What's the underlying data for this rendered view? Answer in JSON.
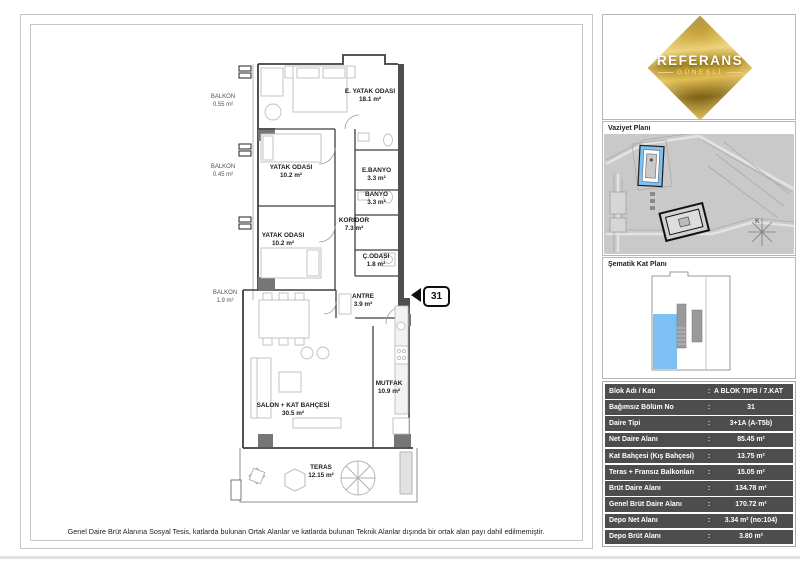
{
  "page": {
    "disclaimer": "Genel Daire Brüt Alanına Sosyal Tesis, katlarda bulunan Ortak Alanlar ve katlarda bulunan Teknik Alanlar dışında bir ortak alan payı dahil edilmemiştir."
  },
  "logo": {
    "title": "REFERANS",
    "subtitle": "GÜNEŞLİ"
  },
  "side": {
    "site_plan_label": "Vaziyet Planı",
    "schematic_label": "Şematik Kat Planı",
    "compass_label": "K"
  },
  "plan": {
    "unit_number": "31",
    "rooms": [
      {
        "name": "E. YATAK ODASI",
        "area": "18.1 m²"
      },
      {
        "name": "YATAK ODASI",
        "area": "10.2 m²"
      },
      {
        "name": "YATAK ODASI",
        "area": "10.2 m²"
      },
      {
        "name": "E.BANYO",
        "area": "3.3 m²"
      },
      {
        "name": "BANYO",
        "area": "3.3 m²"
      },
      {
        "name": "KORIDOR",
        "area": "7.3 m²"
      },
      {
        "name": "Ç.ODASI",
        "area": "1.8 m²"
      },
      {
        "name": "ANTRE",
        "area": "3.9 m²"
      },
      {
        "name": "MUTFAK",
        "area": "10.9 m²"
      },
      {
        "name": "SALON + KAT BAHÇESİ",
        "area": "30.5 m²"
      },
      {
        "name": "TERAS",
        "area": "12.15 m²"
      }
    ],
    "balconies": [
      {
        "name": "BALKON",
        "area": "0.55 m²"
      },
      {
        "name": "BALKON",
        "area": "0.45 m²"
      },
      {
        "name": "BALKON",
        "area": "1.9 m²"
      }
    ]
  },
  "table": {
    "rows": [
      {
        "label": "Blok Adı / Katı",
        "sep": ":",
        "value": "A BLOK TIPB / 7.KAT"
      },
      {
        "label": "Bağımsız Bölüm No",
        "sep": ":",
        "value": "31"
      },
      {
        "label": "Daire Tipi",
        "sep": ":",
        "value": "3+1A (A-T5b)"
      },
      {
        "label": "Net Daire Alanı",
        "sep": ":",
        "value": "85.45 m²"
      },
      {
        "label": "Kat Bahçesi (Kış Bahçesi)",
        "sep": ":",
        "value": "13.75 m²"
      },
      {
        "label": "Teras + Fransız Balkonları",
        "sep": ":",
        "value": "15.05 m²"
      },
      {
        "label": "Brüt Daire Alanı",
        "sep": ":",
        "value": "134.78 m²"
      },
      {
        "label": "Genel Brüt Daire Alanı",
        "sep": ":",
        "value": "170.72 m²"
      },
      {
        "label": "Depo Net Alanı",
        "sep": ":",
        "value": "3.34 m² (no:104)"
      },
      {
        "label": "Depo Brüt Alanı",
        "sep": ":",
        "value": "3.80 m²"
      }
    ]
  },
  "colors": {
    "accent_blue": "#7cc0f4",
    "gold": "#c9a437",
    "table_bg": "#4d4d4d"
  }
}
